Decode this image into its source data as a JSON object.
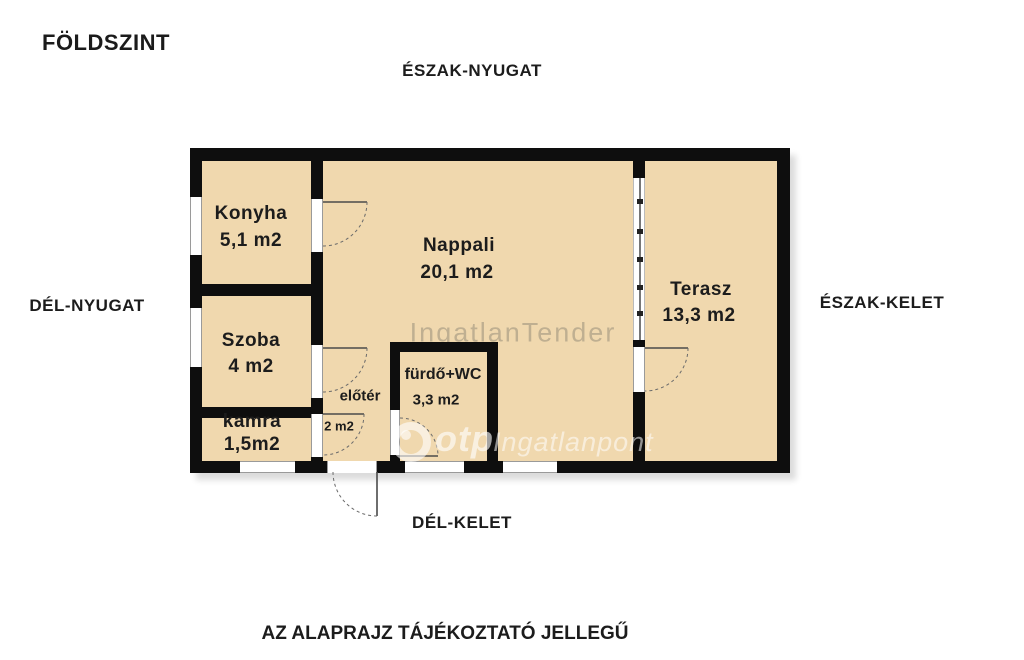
{
  "page": {
    "title": "FÖLDSZINT",
    "caption": "AZ ALAPRAJZ TÁJÉKOZTATÓ JELLEGŰ"
  },
  "compass": {
    "north_west": "ÉSZAK-NYUGAT",
    "south_west": "DÉL-NYUGAT",
    "north_east": "ÉSZAK-KELET",
    "south_east": "DÉL-KELET"
  },
  "rooms": [
    {
      "name": "Konyha",
      "area": "5,1 m2"
    },
    {
      "name": "Nappali",
      "area": "20,1 m2"
    },
    {
      "name": "Terasz",
      "area": "13,3 m2"
    },
    {
      "name": "Szoba",
      "area": "4 m2"
    },
    {
      "name": "kamra",
      "area": "1,5m2"
    },
    {
      "name": "előtér",
      "area": "2 m2"
    },
    {
      "name": "fürdő+WC",
      "area": "3,3 m2"
    }
  ],
  "watermarks": {
    "tender": "IngatlanTender",
    "otp_bold": "otp",
    "otp_rest": "Ingatlanpont"
  },
  "colors": {
    "room_fill": "#f0d8ae",
    "wall": "#0e0e0e",
    "background": "#ffffff",
    "door_line": "#4a4a4a",
    "watermark_gray": "#7d776a",
    "watermark_white": "#ffffff"
  }
}
